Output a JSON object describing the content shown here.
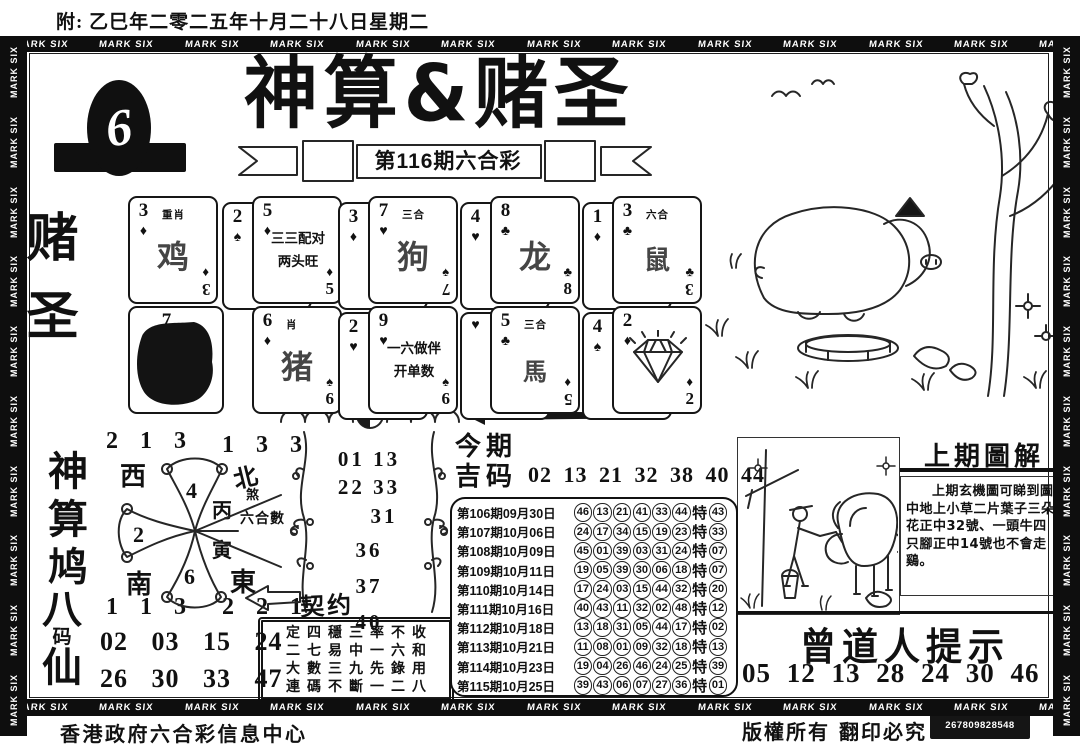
{
  "page": {
    "bg": "#ffffff",
    "ink": "#111111"
  },
  "header": {
    "date_note": "附: 乙巳年二零二五年十月二十八日星期二"
  },
  "border": {
    "label": "MARK SIX"
  },
  "masthead": {
    "title": "神算&赌圣",
    "issue_banner": "第116期六合彩",
    "logo_number": "6"
  },
  "side": {
    "top_label": "赌圣",
    "middle_label": "神算鸠",
    "bottom_label_1": "八",
    "bottom_label_2": "码",
    "bottom_label_3": "仙"
  },
  "cards": {
    "items": [
      {
        "rank": "3",
        "suit": "♦",
        "note": "重肖",
        "zodiac": "鸡",
        "bottom_suit": "♦",
        "bottom_rank": "3"
      },
      {
        "back_rank": "2",
        "back_suit": "♠",
        "rank": "5",
        "suit": "♦",
        "line1": "三三配对",
        "line2": "两头旺",
        "bottom_suit": "♦",
        "bottom_rank": "5"
      },
      {
        "back_rank": "3",
        "back_suit": "♦",
        "rank": "7",
        "suit": "♥",
        "note": "三合",
        "zodiac": "狗",
        "bottom_suit": "♠",
        "bottom_rank": "7"
      },
      {
        "back_rank": "4",
        "back_suit": "♥",
        "rank": "8",
        "suit": "♣",
        "zodiac": "龙",
        "bottom_suit": "♣",
        "bottom_rank": "8"
      },
      {
        "back_rank": "1",
        "back_suit": "♦",
        "rank": "3",
        "suit": "♣",
        "note": "六合",
        "zodiac": "鼠",
        "bottom_suit": "♣",
        "bottom_rank": "3"
      },
      {
        "rank": "7"
      },
      {
        "rank": "6",
        "suit": "♦",
        "note": "肖",
        "zodiac": "猪",
        "bottom_suit": "♠",
        "bottom_rank": "6"
      },
      {
        "back_rank": "2",
        "back_suit": "♥",
        "rank": "9",
        "suit": "♥",
        "line1": "一六做伴",
        "line2": "开单数",
        "bottom_suit": "♠",
        "bottom_rank": "6"
      },
      {
        "back_rank": "",
        "back_suit": "♥",
        "rank": "5",
        "suit": "♣",
        "note": "三合",
        "zodiac": "馬",
        "bottom_suit": "♦",
        "bottom_rank": "5"
      },
      {
        "back_rank": "4",
        "back_suit": "♠",
        "rank": "2",
        "suit": "♦",
        "bottom_suit": "♦",
        "bottom_rank": "2"
      }
    ]
  },
  "compass": {
    "corner_nw": "2 1 3",
    "corner_ne": "1 3 3",
    "corner_sw": "1 1 3",
    "corner_se": "2 2 1",
    "dir_w": "西",
    "dir_n": "北",
    "dir_s": "南",
    "dir_e": "東",
    "sha": "煞",
    "petal_top": "4",
    "petal_left": "2",
    "petal_bottom": "6",
    "center_top": "丙",
    "center_bottom": "寅",
    "pointer_label": "六合數"
  },
  "scroll": {
    "lines": [
      "01 13",
      "22 33",
      "31",
      "36",
      "37",
      "40"
    ]
  },
  "contract": {
    "label": "契约",
    "rows": [
      "定四穩三率不收",
      "二七易中一六和",
      "大數三九先錄用",
      "連碼不斷一二八"
    ]
  },
  "eight_code": {
    "row1": "02 03 15 24",
    "row2": "26 30 33 47"
  },
  "lucky": {
    "title_line1": "今期",
    "title_line2": "吉码",
    "numbers": "02 13 21 32 38 40 44"
  },
  "results": {
    "special_label": "特",
    "rows": [
      {
        "label": "第106期09月30日",
        "nums": [
          "46",
          "13",
          "21",
          "41",
          "33",
          "44"
        ],
        "special": "43"
      },
      {
        "label": "第107期10月06日",
        "nums": [
          "24",
          "17",
          "34",
          "15",
          "19",
          "23"
        ],
        "special": "33"
      },
      {
        "label": "第108期10月09日",
        "nums": [
          "45",
          "01",
          "39",
          "03",
          "31",
          "24"
        ],
        "special": "07"
      },
      {
        "label": "第109期10月11日",
        "nums": [
          "19",
          "05",
          "39",
          "30",
          "06",
          "18"
        ],
        "special": "07"
      },
      {
        "label": "第110期10月14日",
        "nums": [
          "17",
          "24",
          "03",
          "15",
          "44",
          "32"
        ],
        "special": "20"
      },
      {
        "label": "第111期10月16日",
        "nums": [
          "40",
          "43",
          "11",
          "32",
          "02",
          "48"
        ],
        "special": "12"
      },
      {
        "label": "第112期10月18日",
        "nums": [
          "13",
          "18",
          "31",
          "05",
          "44",
          "17"
        ],
        "special": "02"
      },
      {
        "label": "第113期10月21日",
        "nums": [
          "11",
          "08",
          "01",
          "09",
          "32",
          "18"
        ],
        "special": "13"
      },
      {
        "label": "第114期10月23日",
        "nums": [
          "19",
          "04",
          "26",
          "46",
          "24",
          "25"
        ],
        "special": "39"
      },
      {
        "label": "第115期10月25日",
        "nums": [
          "39",
          "43",
          "06",
          "07",
          "27",
          "36"
        ],
        "special": "01"
      }
    ]
  },
  "last_issue": {
    "title": "上期圖解",
    "body": "上期玄機圖可睇到圖中地上小草二片葉子三朵花正中32號、一頭牛四只腳正中14號也不會走鷄。"
  },
  "master_tip": {
    "title": "曾道人提示",
    "numbers": "05 12 13 28 24 30 46"
  },
  "footer": {
    "left": "香港政府六合彩信息中心",
    "right": "版權所有 翻印必究",
    "code": "267809828548"
  },
  "icons": {
    "logo": "egg-six-logo",
    "divider": "wave-arrow-divider",
    "gem": "diamond-gem-icon",
    "sketch_top": "pig-tree-sketch",
    "sketch_bottom": "farmer-buffalo-sketch",
    "branch": "plum-branch-icon"
  }
}
